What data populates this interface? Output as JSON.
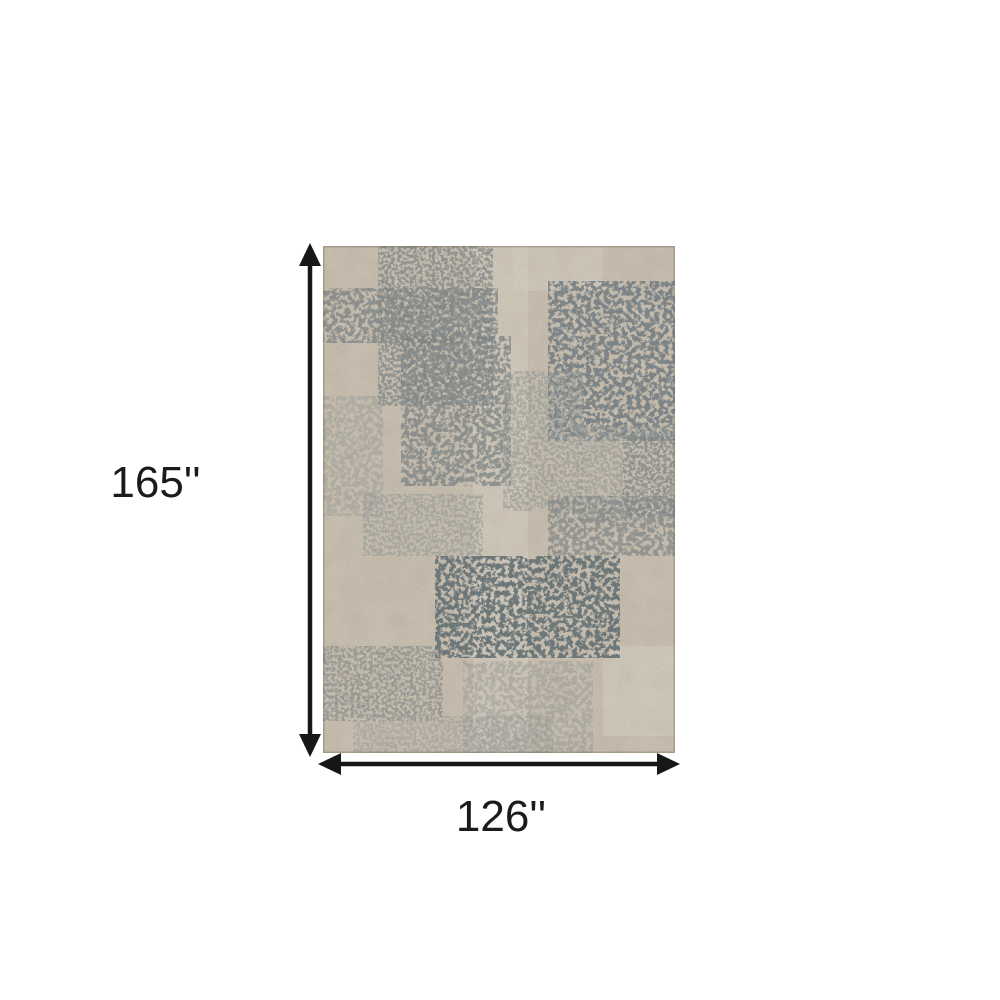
{
  "diagram": {
    "height_label": "165''",
    "width_label": "126''"
  },
  "colors": {
    "background": "#ffffff",
    "arrow": "#171717",
    "label_text": "#1b1b1b",
    "rug_base": "#d5cbbb",
    "rug_base_light": "#e3dccd",
    "rug_gray_light": "#a7aba7",
    "rug_gray": "#8b9293",
    "rug_slate": "#75828a",
    "rug_slate_dark": "#6e7b80"
  }
}
